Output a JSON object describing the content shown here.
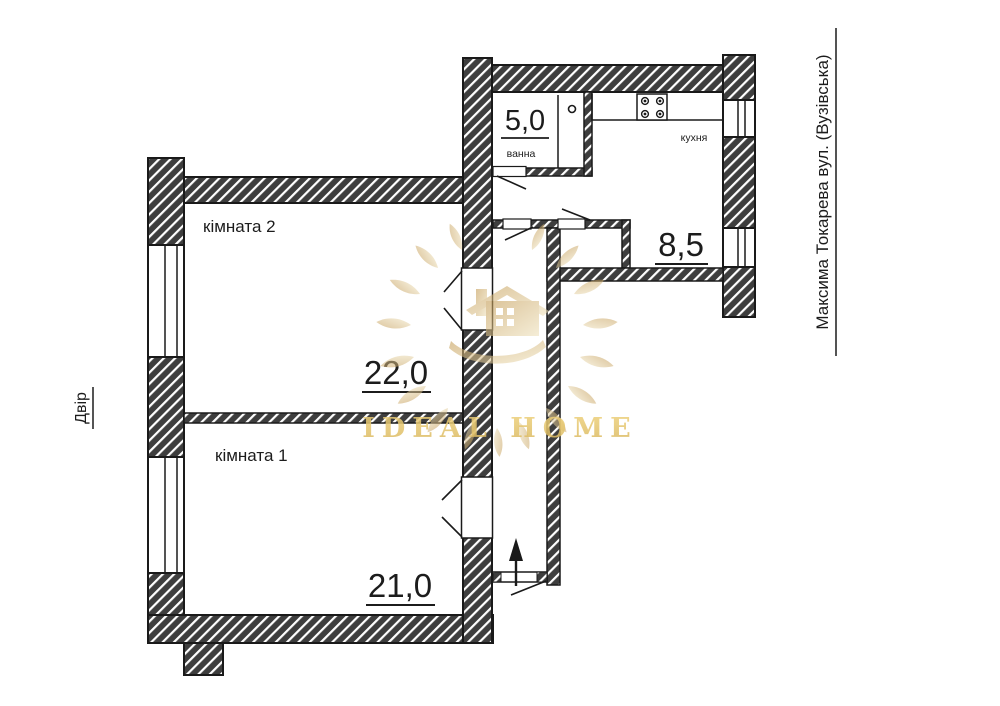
{
  "plan": {
    "rooms": [
      {
        "name": "кімната 2",
        "area": "22,0"
      },
      {
        "name": "кімната 1",
        "area": "21,0"
      },
      {
        "name": "ванна",
        "area": "5,0"
      },
      {
        "name": "кухня",
        "area": "8,5"
      }
    ],
    "labels": {
      "left": "Двір",
      "right": "Максима Токарева вул. (Вузівська)"
    },
    "watermark": {
      "text": "IDEAL HOME"
    },
    "icons": [
      "gas-stove-icon",
      "boiler-icon",
      "entrance-arrow-icon",
      "door-swing-icon",
      "window-icon"
    ],
    "colors": {
      "wall": "#3e3e3e",
      "line": "#1a1a1a",
      "gold": "#e7c568",
      "gold_light": "#eeddb0"
    }
  }
}
